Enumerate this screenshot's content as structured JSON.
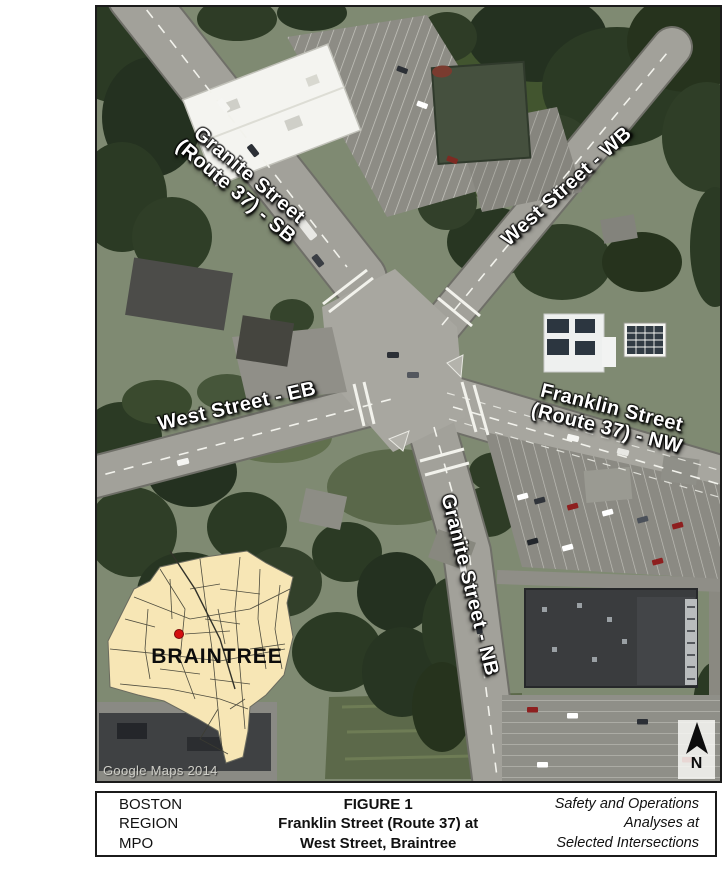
{
  "figure": {
    "attribution": "Google Maps 2014",
    "inset": {
      "town_name": "BRAINTREE",
      "marker": "location-dot"
    },
    "north_arrow": {
      "label": "N",
      "icon": "north-arrow-icon"
    },
    "street_labels": {
      "granite_sb": {
        "line1": "Granite Street",
        "line2": "(Route 37) - SB"
      },
      "west_wb": {
        "text": "West Street - WB"
      },
      "west_eb": {
        "text": "West Street - EB"
      },
      "franklin_nw": {
        "line1": "Franklin Street",
        "line2": "(Route 37) - NW"
      },
      "granite_nb": {
        "text": "Granite Street - NB"
      }
    }
  },
  "title_block": {
    "agency": {
      "line1": "BOSTON",
      "line2": "REGION",
      "line3": "MPO"
    },
    "figure_title": {
      "line1": "FIGURE 1",
      "line2": "Franklin Street (Route 37) at",
      "line3": "West Street, Braintree"
    },
    "project": {
      "line1": "Safety and Operations",
      "line2": "Analyses at",
      "line3": "Selected Intersections"
    }
  },
  "colors": {
    "inset_fill": "#f7e6b5",
    "marker_red": "#d40f0f",
    "label_text": "#ffffff",
    "road_gray": "#a2a19a",
    "canopy_green": "#2b3a24"
  }
}
